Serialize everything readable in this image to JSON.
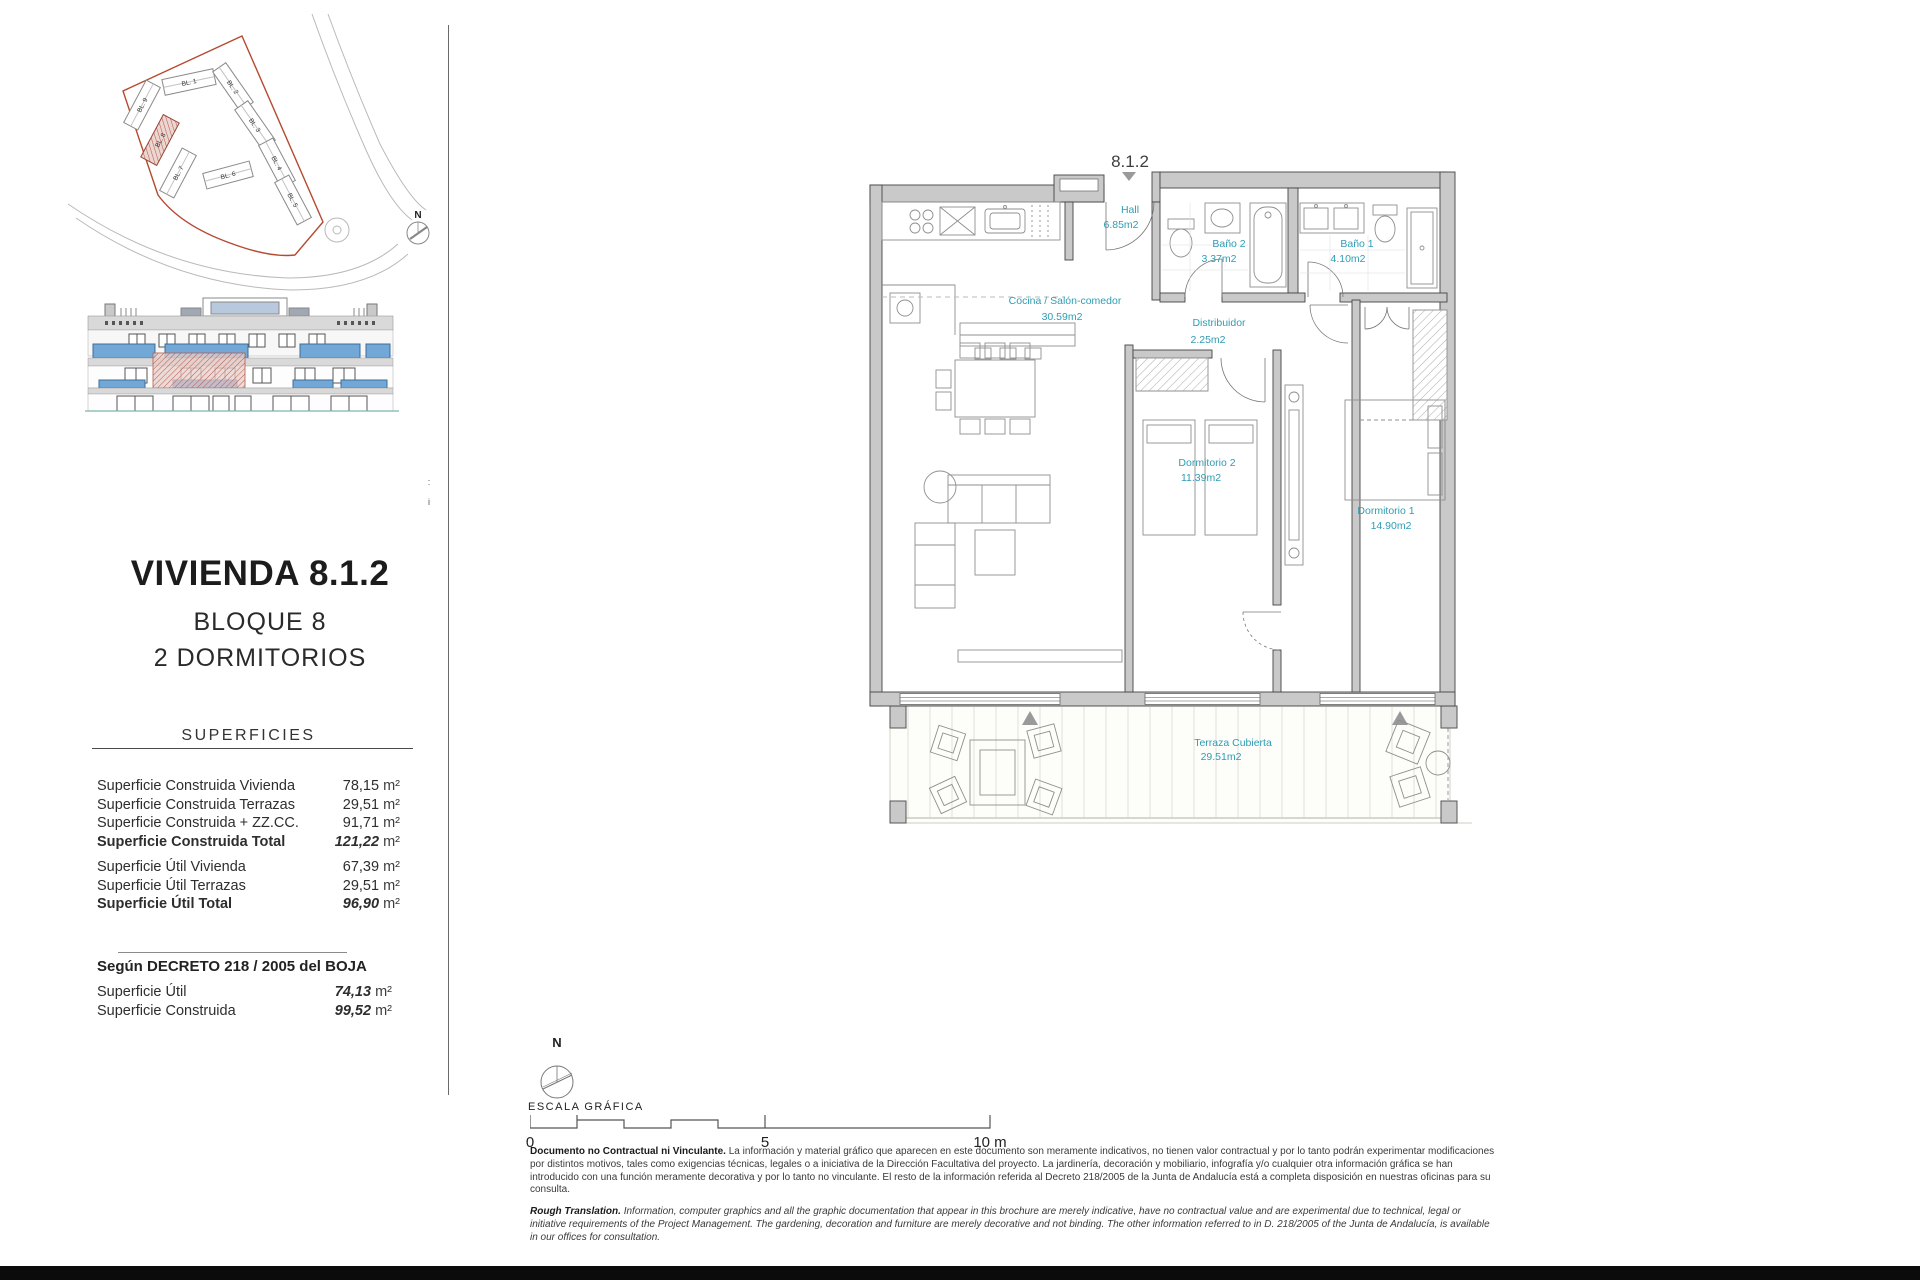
{
  "site_plan": {
    "north_label": "N",
    "blocks": [
      "BL. 1",
      "BL. 2",
      "BL. 3",
      "BL. 4",
      "BL. 5",
      "BL. 6",
      "BL. 7",
      "BL. 8",
      "BL. 9"
    ],
    "highlighted_block": "BL. 8"
  },
  "unit": {
    "title": "VIVIENDA 8.1.2",
    "block": "BLOQUE 8",
    "bedrooms": "2 DORMITORIOS"
  },
  "superficies": {
    "heading": "SUPERFICIES",
    "rows": [
      {
        "label": "Superficie Construida Vivienda",
        "value": "78,15",
        "unit": "m²"
      },
      {
        "label": "Superficie Construida Terrazas",
        "value": "29,51",
        "unit": "m²"
      },
      {
        "label": "Superficie Construida + ZZ.CC.",
        "value": "91,71",
        "unit": "m²"
      },
      {
        "label": "Superficie Construida Total",
        "value": "121,22",
        "unit": "m²"
      },
      {
        "label": "Superficie Útil Vivienda",
        "value": "67,39",
        "unit": "m²"
      },
      {
        "label": "Superficie Útil Terrazas",
        "value": "29,51",
        "unit": "m²"
      },
      {
        "label": "Superficie Útil Total",
        "value": "96,90",
        "unit": "m²"
      }
    ]
  },
  "decreto": {
    "heading": "Según DECRETO 218 / 2005 del BOJA",
    "rows": [
      {
        "label": "Superficie Útil",
        "value": "74,13",
        "unit": "m²"
      },
      {
        "label": "Superficie Construida",
        "value": "99,52",
        "unit": "m²"
      }
    ]
  },
  "margin_marks": {
    "top": ":",
    "bottom": "i"
  },
  "floor_plan": {
    "callout": "8.1.2",
    "rooms": [
      {
        "name": "Hall",
        "area": "6.85m2"
      },
      {
        "name": "Baño 2",
        "area": "3.37m2"
      },
      {
        "name": "Baño 1",
        "area": "4.10m2"
      },
      {
        "name": "Cocina / Salón-comedor",
        "area": "30.59m2"
      },
      {
        "name": "Distribuidor",
        "area": "2.25m2"
      },
      {
        "name": "Dormitorio 2",
        "area": "11.39m2"
      },
      {
        "name": "Dormitorio 1",
        "area": "14.90m2"
      },
      {
        "name": "Terraza Cubierta",
        "area": "29.51m2"
      }
    ],
    "label_color": "#2E9DB4"
  },
  "scale_bar": {
    "north_label": "N",
    "title": "ESCALA GRÁFICA",
    "tick0": "0",
    "tick5": "5",
    "tick10": "10 m"
  },
  "disclaimer": {
    "es_lead": "Documento no Contractual ni Vinculante.",
    "es_body": " La información y material gráfico que aparecen en este documento son meramente indicativos, no tienen valor contractual y por lo tanto podrán experimentar modificaciones por distintos motivos, tales como exigencias técnicas, legales o a iniciativa de la Dirección Facultativa del proyecto. La jardinería, decoración y mobiliario, infografía y/o cualquier otra información gráfica se han introducido con una función meramente decorativa y por lo tanto no vinculante. El resto de la información referida al Decreto 218/2005 de la Junta de Andalucía está a completa disposición en nuestras oficinas para su consulta.",
    "en_lead": "Rough Translation.",
    "en_body": " Information, computer graphics and all the graphic documentation that appear in this brochure are merely indicative, have no contractual value and are experimental due to technical, legal or initiative requirements of the Project Management. The gardening, decoration and furniture are merely decorative and not binding. The other information referred to in D. 218/2005 of the Junta de Andalucía, is available in our offices for consultation."
  },
  "colors": {
    "accent_teal": "#2E9DB4",
    "boundary_red": "#B5492F",
    "highlight_red": "#C0504D",
    "window_blue": "#71A8D7",
    "wall_gray": "#C9C9C9"
  }
}
